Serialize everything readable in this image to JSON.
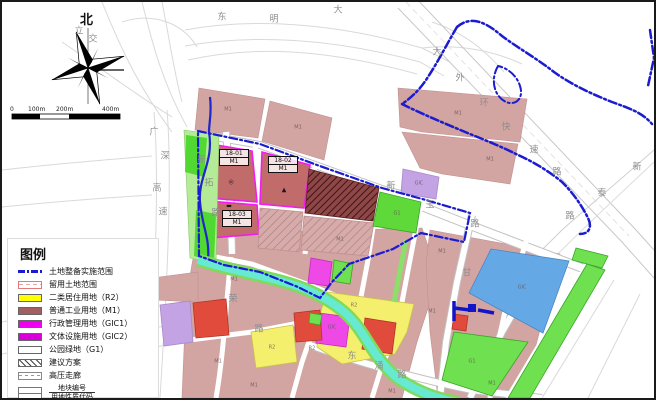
{
  "compass": {
    "north_label": "北"
  },
  "scale_bar": {
    "ticks": [
      "0",
      "100m",
      "200m",
      "400m"
    ]
  },
  "legend": {
    "title": "图例",
    "items": [
      {
        "label": "土地整备实施范围"
      },
      {
        "label": "留用土地范围"
      },
      {
        "label": "二类居住用地（R2）"
      },
      {
        "label": "普通工业用地（M1）"
      },
      {
        "label": "行政管理用地（GIC1）"
      },
      {
        "label": "文体设施用地（GIC2）"
      },
      {
        "label": "公园绿地（G1）"
      },
      {
        "label": "建议方案"
      },
      {
        "label": "高压走廊"
      },
      {
        "label": "地块编号",
        "label2": "用地性质代码"
      }
    ]
  },
  "colors": {
    "boundary_blue": "#1b1bd0",
    "residential_yellow": "#f4ef6d",
    "industrial_dark": "#c26b6b",
    "industrial_light": "#d2a4a2",
    "gic_magenta": "#ee49e6",
    "park_green": "#5fd93a",
    "water_blue": "#64a9e6",
    "creek_cyan": "#68ead2",
    "red_block": "#e14b3c",
    "purple_block": "#c3a3e3"
  },
  "map": {
    "block_labels": [
      {
        "no": "18-01",
        "code": "M1",
        "x": 217,
        "y": 147
      },
      {
        "no": "18-02",
        "code": "M1",
        "x": 266,
        "y": 154
      },
      {
        "no": "18-03",
        "code": "M1",
        "x": 220,
        "y": 208
      }
    ],
    "symbols": [
      {
        "t": "◎",
        "x": 229,
        "y": 180
      },
      {
        "t": "▲",
        "x": 282,
        "y": 188
      },
      {
        "t": "▬",
        "x": 227,
        "y": 204
      }
    ],
    "road_labels": [
      {
        "t": "东",
        "x": 220,
        "y": 14
      },
      {
        "t": "明",
        "x": 272,
        "y": 16
      },
      {
        "t": "大",
        "x": 336,
        "y": 7
      },
      {
        "t": "立",
        "x": 77,
        "y": 28
      },
      {
        "t": "交",
        "x": 91,
        "y": 36
      },
      {
        "t": "广",
        "x": 152,
        "y": 129
      },
      {
        "t": "深",
        "x": 163,
        "y": 153
      },
      {
        "t": "高",
        "x": 155,
        "y": 185
      },
      {
        "t": "速",
        "x": 161,
        "y": 209
      },
      {
        "t": "新",
        "x": 200,
        "y": 157
      },
      {
        "t": "拓",
        "x": 207,
        "y": 180
      },
      {
        "t": "路",
        "x": 214,
        "y": 210
      },
      {
        "t": "大",
        "x": 435,
        "y": 49
      },
      {
        "t": "外",
        "x": 458,
        "y": 75
      },
      {
        "t": "环",
        "x": 482,
        "y": 100
      },
      {
        "t": "快",
        "x": 504,
        "y": 124
      },
      {
        "t": "速",
        "x": 532,
        "y": 147
      },
      {
        "t": "路",
        "x": 555,
        "y": 169
      },
      {
        "t": "新",
        "x": 635,
        "y": 164
      },
      {
        "t": "泰",
        "x": 600,
        "y": 190
      },
      {
        "t": "路",
        "x": 568,
        "y": 213
      },
      {
        "t": "新",
        "x": 389,
        "y": 183
      },
      {
        "t": "玉",
        "x": 428,
        "y": 202
      },
      {
        "t": "路",
        "x": 473,
        "y": 221
      },
      {
        "t": "荣",
        "x": 231,
        "y": 296
      },
      {
        "t": "路",
        "x": 257,
        "y": 326
      },
      {
        "t": "东",
        "x": 350,
        "y": 353
      },
      {
        "t": "涌",
        "x": 377,
        "y": 363
      },
      {
        "t": "路",
        "x": 400,
        "y": 372
      },
      {
        "t": "甘",
        "x": 465,
        "y": 270
      }
    ],
    "parcel_codes": [
      {
        "t": "M1",
        "x": 226,
        "y": 108
      },
      {
        "t": "M1",
        "x": 296,
        "y": 126
      },
      {
        "t": "M1",
        "x": 456,
        "y": 112
      },
      {
        "t": "M1",
        "x": 488,
        "y": 158
      },
      {
        "t": "GIC",
        "x": 417,
        "y": 182
      },
      {
        "t": "G1",
        "x": 395,
        "y": 212
      },
      {
        "t": "M1",
        "x": 338,
        "y": 238
      },
      {
        "t": "M1",
        "x": 440,
        "y": 250
      },
      {
        "t": "GIC",
        "x": 520,
        "y": 286
      },
      {
        "t": "M1",
        "x": 232,
        "y": 278
      },
      {
        "t": "R2",
        "x": 270,
        "y": 346
      },
      {
        "t": "R2",
        "x": 352,
        "y": 304
      },
      {
        "t": "GIC",
        "x": 330,
        "y": 326
      },
      {
        "t": "R2",
        "x": 310,
        "y": 347
      },
      {
        "t": "M1",
        "x": 216,
        "y": 360
      },
      {
        "t": "M1",
        "x": 252,
        "y": 384
      },
      {
        "t": "M1",
        "x": 430,
        "y": 310
      },
      {
        "t": "G1",
        "x": 470,
        "y": 360
      },
      {
        "t": "M1",
        "x": 490,
        "y": 382
      },
      {
        "t": "M1",
        "x": 390,
        "y": 390
      }
    ]
  }
}
